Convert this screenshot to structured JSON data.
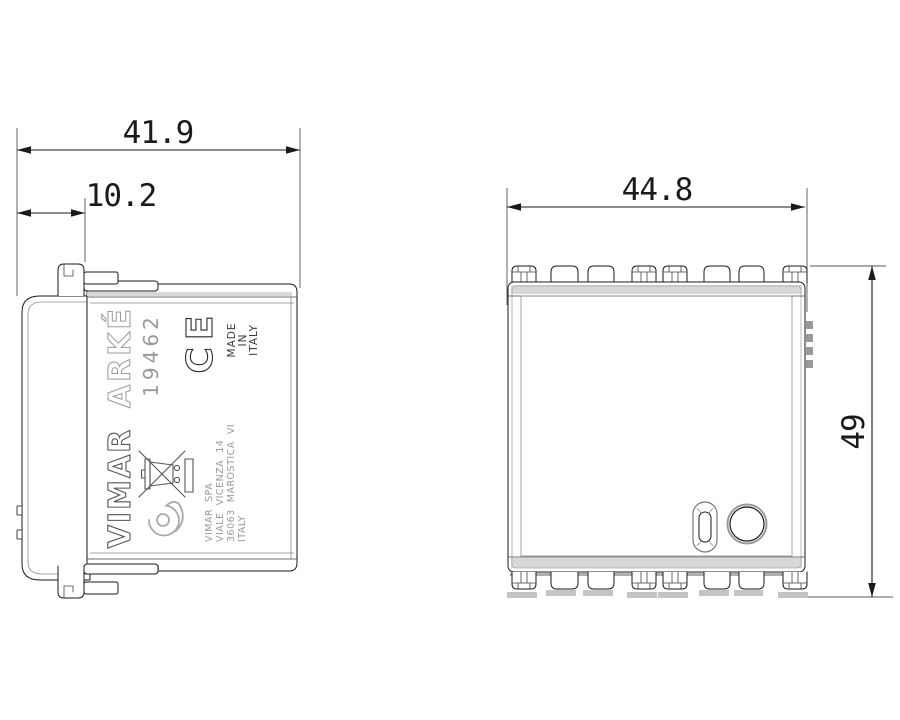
{
  "drawing": {
    "type": "product dimensional drawing",
    "background": "#ffffff"
  },
  "dimensions": {
    "total_depth": "41.9",
    "front_depth": "10.2",
    "width": "44.8",
    "height": "49"
  },
  "views": {
    "side_view": {
      "brand_logo": "ARKÉ",
      "product_code": "19462",
      "ce_mark": "CE",
      "made_in": [
        "MADE",
        "IN",
        "ITALY"
      ],
      "brand": "VIMAR",
      "address": [
        "VIMAR  SPA",
        "VIALE  VICENZA  14",
        "36063  MAROSTICA  VI",
        "ITALY"
      ]
    },
    "front_view": {}
  },
  "icons": {
    "weee": "weee-crossed-bin-icon",
    "insulation_bar": "insulation-bar-icon",
    "horn_mark": "horn-mark-icon",
    "led_window": "led-window",
    "push_button": "push-button",
    "mounting_tab": "mounting-tab",
    "side_teeth": "side-teeth"
  },
  "colors": {
    "line": "#1a1a1a",
    "gray_line": "#8c8c8c",
    "light_text": "#9a9a9a",
    "shade": "#d8d8d8",
    "background": "#ffffff"
  }
}
